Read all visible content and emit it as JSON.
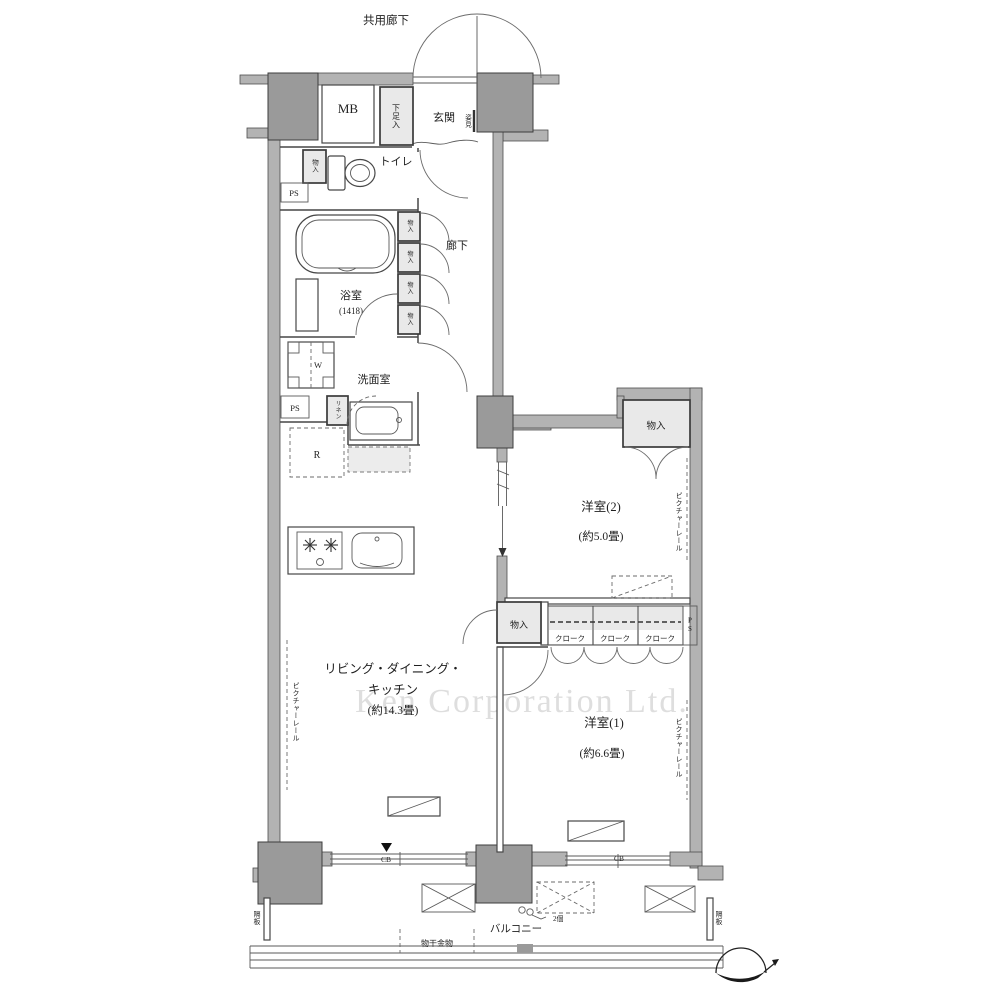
{
  "plan": {
    "common_corridor": "共用廊下",
    "watermark": "Ken Corporation Ltd.",
    "meter_box": "MB",
    "entrance": {
      "label": "玄関",
      "shoe_box": "下足入",
      "mirror": "姿見"
    },
    "toilet": {
      "label": "トイレ",
      "storage": "物入",
      "pipe_space": "PS"
    },
    "bathroom": {
      "label": "浴室",
      "size": "(1418)"
    },
    "hallway": {
      "label": "廊下",
      "storage": "物入"
    },
    "washroom": {
      "label": "洗面室",
      "washer": "W",
      "linen": "リネン",
      "pipe_space": "PS"
    },
    "kitchen": {
      "refrigerator": "R"
    },
    "ldk": {
      "name_line1": "リビング・ダイニング・",
      "name_line2": "キッチン",
      "size": "(約14.3畳)",
      "storage": "物入",
      "picture_rail": "ピクチャーレール"
    },
    "bedroom2": {
      "name": "洋室(2)",
      "size": "(約5.0畳)",
      "storage": "物入",
      "picture_rail": "ピクチャーレール"
    },
    "bedroom1": {
      "name": "洋室(1)",
      "size": "(約6.6畳)",
      "cloak": "クローク",
      "pipe_space": "PS",
      "picture_rail": "ピクチャーレール"
    },
    "balcony": {
      "label": "バルコニー",
      "laundry_hardware": "物干金物",
      "partition": "隔板",
      "cb": "CB",
      "note": "2個"
    }
  }
}
